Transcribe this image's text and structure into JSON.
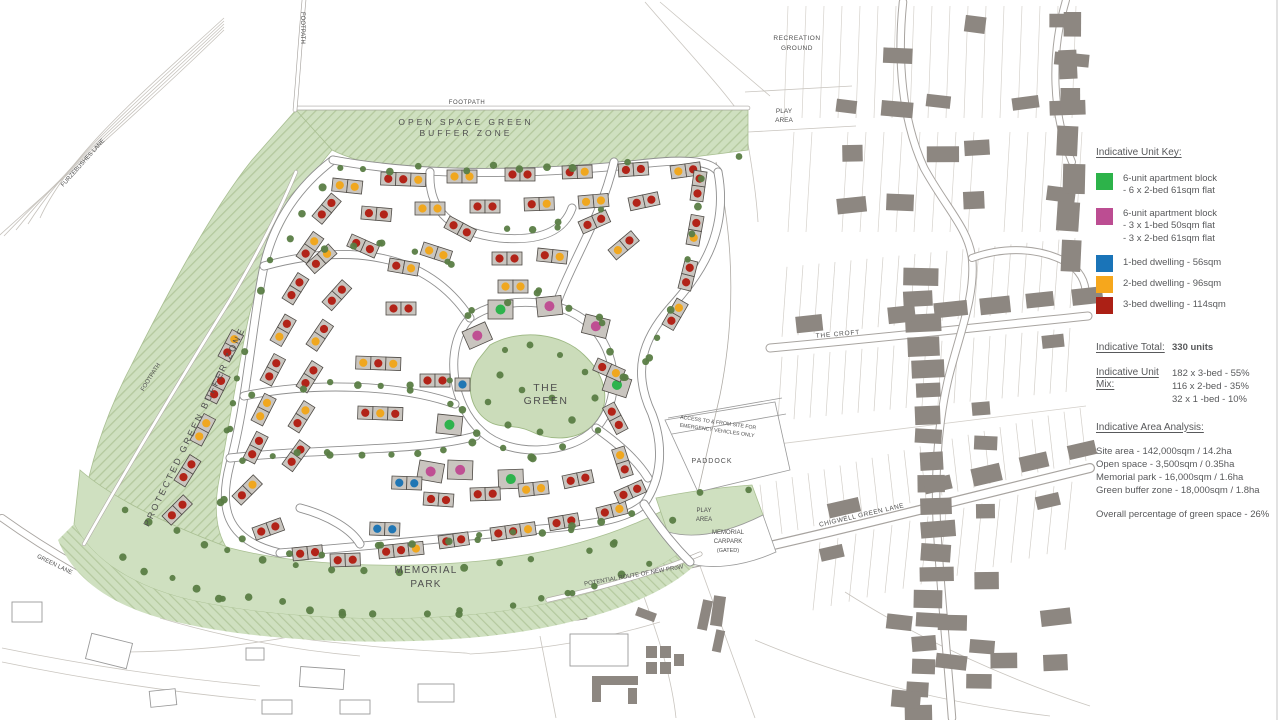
{
  "legend": {
    "unit_key_title": "Indicative Unit Key:",
    "items": [
      {
        "name": "apartment-6-unit-green",
        "color": "#2db34a",
        "lines": [
          "6-unit apartment block",
          "- 6 x 2-bed 61sqm flat"
        ]
      },
      {
        "name": "apartment-6-unit-pink",
        "color": "#bc4d92",
        "lines": [
          "6-unit apartment block",
          "- 3 x 1-bed 50sqm flat",
          "- 3 x 2-bed 61sqm flat"
        ]
      },
      {
        "name": "dwelling-1-bed",
        "color": "#1a74b8",
        "lines": [
          "1-bed dwelling - 56sqm"
        ]
      },
      {
        "name": "dwelling-2-bed",
        "color": "#f6a71c",
        "lines": [
          "2-bed dwelling - 96sqm"
        ]
      },
      {
        "name": "dwelling-3-bed",
        "color": "#ac2015",
        "lines": [
          "3-bed dwelling - 114sqm"
        ]
      }
    ],
    "total_label": "Indicative Total:",
    "total_value": "330 units",
    "mix_label": "Indicative Unit Mix:",
    "mix_lines": [
      "182 x 3-bed - 55%",
      "116 x 2-bed - 35%",
      "32 x 1 -bed - 10%"
    ],
    "area_title": "Indicative Area Analysis:",
    "area_lines": [
      "Site area - 142,000sqm / 14.2ha",
      "Open space - 3,500sqm / 0.35ha",
      "Memorial park - 16,000sqm / 1.6ha",
      "Green buffer zone - 18,000sqm / 1.8ha"
    ],
    "green_space_line": "Overall percentage of green space - 26%"
  },
  "map_labels": {
    "footpath_vertical": "FOOTPATH",
    "footpath_top": "FOOTPATH",
    "footpath_left": "FOOTPATH",
    "open_space_line1": "OPEN SPACE GREEN",
    "open_space_line2": "BUFFER ZONE",
    "protected_buffer": "PROTECTED GREEN BUFFER ZONE",
    "recreation_line1": "RECREATION",
    "recreation_line2": "GROUND",
    "play_area_ne_line1": "PLAY",
    "play_area_ne_line2": "AREA",
    "the_croft": "THE CROFT",
    "chigwell_green_lane": "CHIGWELL GREEN LANE",
    "furzebushes_lane": "FURZEBUSHES LANE",
    "green_lane": "GREEN LANE",
    "the_green_line1": "THE",
    "the_green_line2": "GREEN",
    "memorial_park_line1": "MEMORIAL",
    "memorial_park_line2": "PARK",
    "access_line1": "ACCESS TO & FROM SITE FOR",
    "access_line2": "EMERGENCY VEHICLES ONLY",
    "paddock": "PADDOCK",
    "play_area_s_line1": "PLAY",
    "play_area_s_line2": "AREA",
    "carpark_line1": "MEMORIAL",
    "carpark_line2": "CARPARK",
    "carpark_line3": "(GATED)",
    "prow": "POTENTIAL ROUTE OF NEW PRoW"
  },
  "colors": {
    "unit": {
      "r": "#b22318",
      "o": "#f0a71f",
      "b": "#2076b4",
      "g": "#2eb34d",
      "p": "#bf4f93"
    },
    "tree": "#5a7d45",
    "green_fill": "#cfe0c0",
    "green_hatch": "#b4c99e",
    "building_grey": "#8d8781",
    "house_grey": "#c9c5bf"
  },
  "house_rows": [
    [
      333,
      178,
      6,
      "oo"
    ],
    [
      381,
      172,
      2,
      "rro"
    ],
    [
      447,
      170,
      0,
      "oo"
    ],
    [
      505,
      168,
      0,
      "rr"
    ],
    [
      562,
      166,
      -2,
      "ro"
    ],
    [
      618,
      164,
      -4,
      "rr"
    ],
    [
      670,
      166,
      -8,
      "or"
    ],
    [
      362,
      206,
      5,
      "rr"
    ],
    [
      415,
      202,
      0,
      "oo"
    ],
    [
      470,
      200,
      0,
      "rr"
    ],
    [
      524,
      198,
      -2,
      "ro"
    ],
    [
      578,
      196,
      -5,
      "oo"
    ],
    [
      628,
      198,
      -12,
      "rr"
    ],
    [
      312,
      216,
      -50,
      "rr"
    ],
    [
      296,
      256,
      -55,
      "ro"
    ],
    [
      282,
      298,
      -58,
      "rr"
    ],
    [
      270,
      340,
      -60,
      "or"
    ],
    [
      260,
      380,
      -62,
      "rr"
    ],
    [
      251,
      420,
      -63,
      "oo"
    ],
    [
      243,
      458,
      -63,
      "rr"
    ],
    [
      218,
      356,
      -62,
      "ro"
    ],
    [
      205,
      398,
      -63,
      "rr"
    ],
    [
      190,
      440,
      -62,
      "oo"
    ],
    [
      174,
      480,
      -58,
      "rr"
    ],
    [
      162,
      516,
      -45,
      "rr"
    ],
    [
      232,
      496,
      -45,
      "ro"
    ],
    [
      252,
      528,
      -20,
      "rr"
    ],
    [
      292,
      548,
      -6,
      "rr"
    ],
    [
      306,
      264,
      -42,
      "ro"
    ],
    [
      322,
      302,
      -48,
      "rr"
    ],
    [
      306,
      344,
      -56,
      "or"
    ],
    [
      296,
      386,
      -58,
      "rr"
    ],
    [
      288,
      426,
      -58,
      "ro"
    ],
    [
      282,
      464,
      -54,
      "rr"
    ],
    [
      356,
      356,
      2,
      "oro"
    ],
    [
      358,
      406,
      2,
      "ror"
    ],
    [
      420,
      374,
      0,
      "rr"
    ],
    [
      455,
      378,
      0,
      "b"
    ],
    [
      352,
      234,
      24,
      "rr"
    ],
    [
      390,
      258,
      10,
      "ro"
    ],
    [
      386,
      302,
      0,
      "rr"
    ],
    [
      424,
      242,
      18,
      "oo"
    ],
    [
      450,
      216,
      28,
      "rr"
    ],
    [
      492,
      252,
      0,
      "rr"
    ],
    [
      538,
      248,
      6,
      "ro"
    ],
    [
      578,
      222,
      -24,
      "rr"
    ],
    [
      608,
      250,
      -40,
      "or"
    ],
    [
      498,
      280,
      0,
      "oo"
    ],
    [
      690,
      200,
      -82,
      "rr"
    ],
    [
      686,
      244,
      -80,
      "or"
    ],
    [
      678,
      288,
      -76,
      "rr"
    ],
    [
      662,
      324,
      -60,
      "ro"
    ],
    [
      488,
      300,
      0,
      "G"
    ],
    [
      536,
      298,
      -6,
      "P"
    ],
    [
      462,
      332,
      -24,
      "P"
    ],
    [
      586,
      314,
      14,
      "P"
    ],
    [
      608,
      372,
      18,
      "G"
    ],
    [
      438,
      414,
      6,
      "G"
    ],
    [
      420,
      460,
      10,
      "P"
    ],
    [
      448,
      460,
      2,
      "P"
    ],
    [
      498,
      470,
      -2,
      "G"
    ],
    [
      598,
      358,
      24,
      "ro"
    ],
    [
      614,
      402,
      62,
      "rr"
    ],
    [
      624,
      446,
      72,
      "or"
    ],
    [
      392,
      476,
      2,
      "bb"
    ],
    [
      370,
      522,
      2,
      "bb"
    ],
    [
      424,
      492,
      4,
      "rr"
    ],
    [
      470,
      488,
      -2,
      "rr"
    ],
    [
      518,
      484,
      -6,
      "oo"
    ],
    [
      562,
      476,
      -12,
      "rr"
    ],
    [
      330,
      554,
      -2,
      "rr"
    ],
    [
      378,
      546,
      -6,
      "rro"
    ],
    [
      438,
      536,
      -8,
      "rr"
    ],
    [
      490,
      528,
      -8,
      "rro"
    ],
    [
      548,
      518,
      -10,
      "rr"
    ],
    [
      596,
      508,
      -14,
      "ro"
    ],
    [
      614,
      492,
      -24,
      "rr"
    ]
  ]
}
